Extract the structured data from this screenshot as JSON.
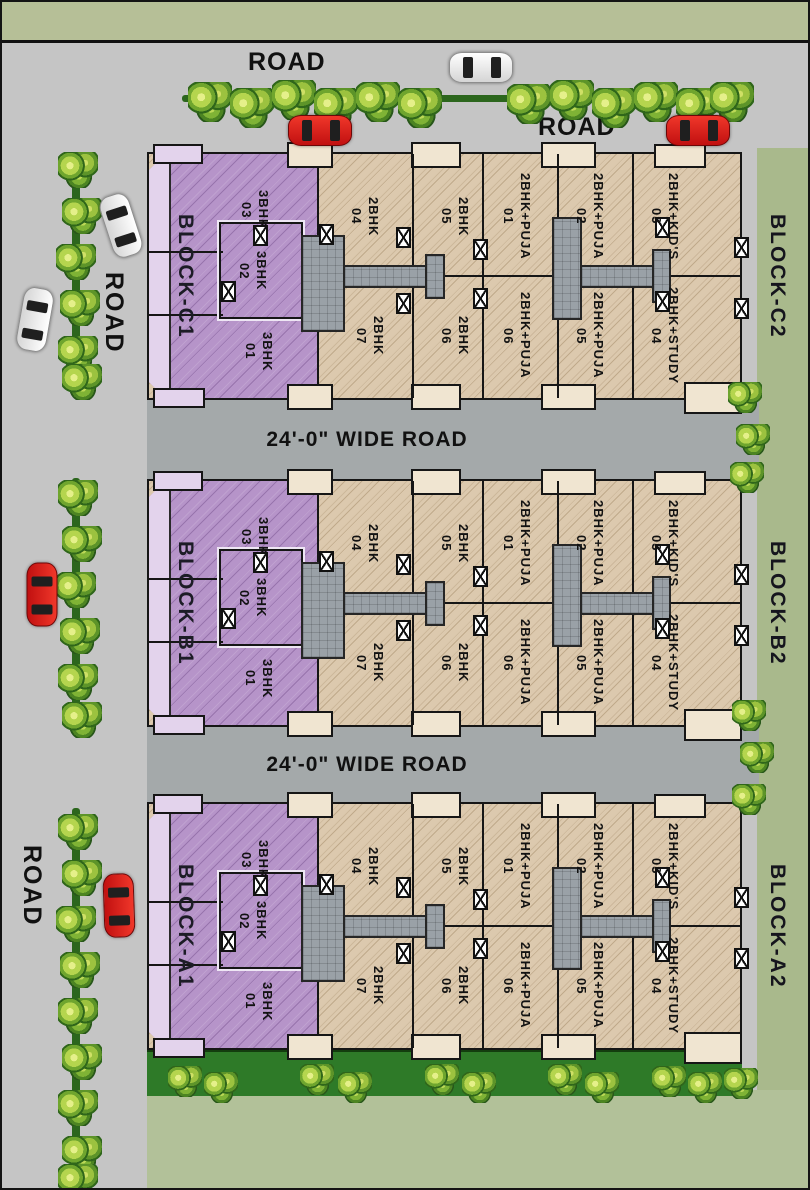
{
  "site": {
    "top_road": {
      "label_1": "ROAD",
      "label_2": "ROAD"
    },
    "left_road": {
      "label_1": "ROAD",
      "label_2": "ROAD"
    },
    "wide_road_label_1": "24'-0\" WIDE ROAD",
    "wide_road_label_2": "24'-0\" WIDE ROAD",
    "rows": [
      {
        "block_left": "BLOCK-C1",
        "block_right": "BLOCK-C2",
        "purple_units": [
          {
            "type": "3BHK",
            "no": "03"
          },
          {
            "type": "3BHK",
            "no": "02"
          },
          {
            "type": "3BHK",
            "no": "01"
          }
        ],
        "top_units": [
          {
            "type": "2BHK",
            "no": "04"
          },
          {
            "type": "2BHK",
            "no": "05"
          },
          {
            "type": "2BHK+PUJA",
            "no": "01"
          },
          {
            "type": "2BHK+PUJA",
            "no": "02"
          },
          {
            "type": "2BHK+KID'S",
            "no": "03"
          }
        ],
        "bottom_units": [
          {
            "type": "2BHK",
            "no": "07"
          },
          {
            "type": "2BHK",
            "no": "06"
          },
          {
            "type": "2BHK+PUJA",
            "no": "06"
          },
          {
            "type": "2BHK+PUJA",
            "no": "05"
          },
          {
            "type": "2BHK+STUDY",
            "no": "04"
          }
        ]
      },
      {
        "block_left": "BLOCK-B1",
        "block_right": "BLOCK-B2",
        "purple_units": [
          {
            "type": "3BHK",
            "no": "03"
          },
          {
            "type": "3BHK",
            "no": "02"
          },
          {
            "type": "3BHK",
            "no": "01"
          }
        ],
        "top_units": [
          {
            "type": "2BHK",
            "no": "04"
          },
          {
            "type": "2BHK",
            "no": "05"
          },
          {
            "type": "2BHK+PUJA",
            "no": "01"
          },
          {
            "type": "2BHK+PUJA",
            "no": "02"
          },
          {
            "type": "2BHK+KID'S",
            "no": "03"
          }
        ],
        "bottom_units": [
          {
            "type": "2BHK",
            "no": "07"
          },
          {
            "type": "2BHK",
            "no": "06"
          },
          {
            "type": "2BHK+PUJA",
            "no": "06"
          },
          {
            "type": "2BHK+PUJA",
            "no": "05"
          },
          {
            "type": "2BHK+STUDY",
            "no": "04"
          }
        ]
      },
      {
        "block_left": "BLOCK-A1",
        "block_right": "BLOCK-A2",
        "purple_units": [
          {
            "type": "3BHK",
            "no": "03"
          },
          {
            "type": "3BHK",
            "no": "02"
          },
          {
            "type": "3BHK",
            "no": "01"
          }
        ],
        "top_units": [
          {
            "type": "2BHK",
            "no": "04"
          },
          {
            "type": "2BHK",
            "no": "05"
          },
          {
            "type": "2BHK+PUJA",
            "no": "01"
          },
          {
            "type": "2BHK+PUJA",
            "no": "02"
          },
          {
            "type": "2BHK+KID'S",
            "no": "03"
          }
        ],
        "bottom_units": [
          {
            "type": "2BHK",
            "no": "07"
          },
          {
            "type": "2BHK",
            "no": "06"
          },
          {
            "type": "2BHK+PUJA",
            "no": "06"
          },
          {
            "type": "2BHK+PUJA",
            "no": "05"
          },
          {
            "type": "2BHK+STUDY",
            "no": "04"
          }
        ]
      }
    ],
    "colors": {
      "purple_block": "#b694c9",
      "purple_light": "#e3d3ec",
      "beige_unit": "#dcc9ae",
      "cream_balcony": "#f0e5d1",
      "outer_road": "#c5c5c5",
      "wide_road": "#a4a9aa",
      "green_area": "#a9b98c",
      "lawn": "#2e7a28",
      "stair_core": "#9aa1a7"
    }
  }
}
